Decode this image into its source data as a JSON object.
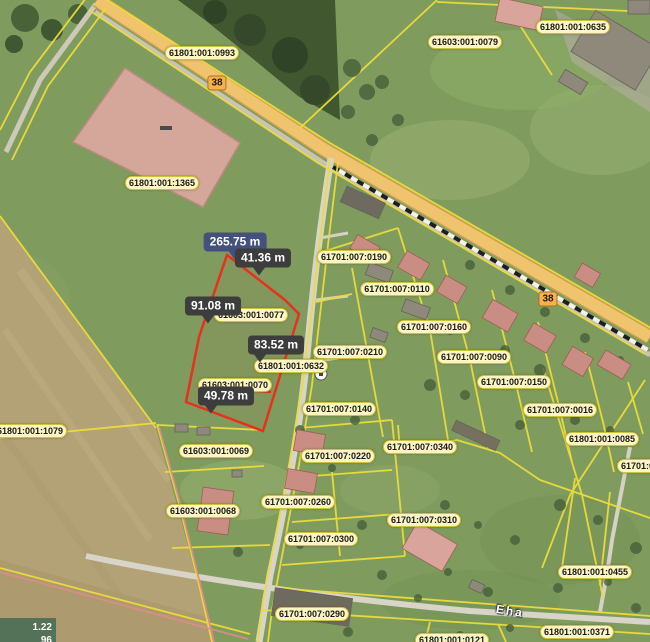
{
  "app": {
    "type": "cadastral-map-viewer"
  },
  "map": {
    "parcel_labels": [
      {
        "text": "61801:001:0993",
        "x": 202,
        "y": 53
      },
      {
        "text": "61801:001:1365",
        "x": 162,
        "y": 183
      },
      {
        "text": "61603:001:0079",
        "x": 465,
        "y": 42
      },
      {
        "text": "61801:001:0635",
        "x": 573,
        "y": 27
      },
      {
        "text": "61701:007:0190",
        "x": 354,
        "y": 257
      },
      {
        "text": "61701:007:0110",
        "x": 397,
        "y": 289
      },
      {
        "text": "61701:007:0160",
        "x": 434,
        "y": 327
      },
      {
        "text": "61701:007:0210",
        "x": 350,
        "y": 352
      },
      {
        "text": "61701:007:0090",
        "x": 474,
        "y": 357
      },
      {
        "text": "61701:007:0150",
        "x": 514,
        "y": 382
      },
      {
        "text": "61701:007:0140",
        "x": 339,
        "y": 409
      },
      {
        "text": "61701:007:0016",
        "x": 560,
        "y": 410
      },
      {
        "text": "61801:001:0085",
        "x": 602,
        "y": 439
      },
      {
        "text": "61701:00",
        "x": 640,
        "y": 466
      },
      {
        "text": "61801:001:1079",
        "x": 30,
        "y": 431
      },
      {
        "text": "61603:001:0069",
        "x": 216,
        "y": 451
      },
      {
        "text": "61603:001:0068",
        "x": 203,
        "y": 511
      },
      {
        "text": "61701:007:0220",
        "x": 338,
        "y": 456
      },
      {
        "text": "61701:007:0260",
        "x": 298,
        "y": 502
      },
      {
        "text": "61701:007:0300",
        "x": 321,
        "y": 539
      },
      {
        "text": "61701:007:0290",
        "x": 312,
        "y": 614
      },
      {
        "text": "61701:007:0340",
        "x": 420,
        "y": 447
      },
      {
        "text": "61701:007:0310",
        "x": 424,
        "y": 520
      },
      {
        "text": "61801:001:0455",
        "x": 595,
        "y": 572
      },
      {
        "text": "61801:001:0371",
        "x": 577,
        "y": 632
      },
      {
        "text": "61801:001:0121",
        "x": 452,
        "y": 640
      },
      {
        "text": "61603:001:0077",
        "x": 251,
        "y": 315
      },
      {
        "text": "61801:001:0632",
        "x": 291,
        "y": 366
      },
      {
        "text": "61603:001:0070",
        "x": 235,
        "y": 385
      }
    ],
    "road_badges": [
      {
        "text": "38",
        "x": 217,
        "y": 83
      },
      {
        "text": "38",
        "x": 548,
        "y": 299
      }
    ],
    "street_label": {
      "text": "Eha",
      "x": 510,
      "y": 611,
      "rotation": 9
    },
    "measurements": [
      {
        "text": "265.75 m",
        "x": 235,
        "y": 242,
        "arrow_x": 234,
        "style": "total"
      },
      {
        "text": "41.36 m",
        "x": 263,
        "y": 258,
        "arrow_x": 259,
        "style": "segment"
      },
      {
        "text": "91.08 m",
        "x": 213,
        "y": 306,
        "arrow_x": 208,
        "style": "segment"
      },
      {
        "text": "83.52 m",
        "x": 276,
        "y": 345,
        "arrow_x": 260,
        "style": "segment"
      },
      {
        "text": "49.78 m",
        "x": 226,
        "y": 396,
        "arrow_x": 211,
        "style": "segment"
      }
    ],
    "coordinate_readout": {
      "line1": "1.22",
      "line2": "96"
    },
    "colors": {
      "parcel_line": "#ecdc3c",
      "measure_outline": "#e8301e",
      "label_bg": "#fdf6c2",
      "tooltip_bg": "#3d3d3d",
      "tooltip_total_bg": "#44517d",
      "road_fill": "#f0c36e",
      "field_fill": "#b3a276",
      "forest_fill": "#40572f",
      "highlight_parcel_fill": "#d9a89e",
      "pink_boundary": "#e08b8b"
    }
  }
}
